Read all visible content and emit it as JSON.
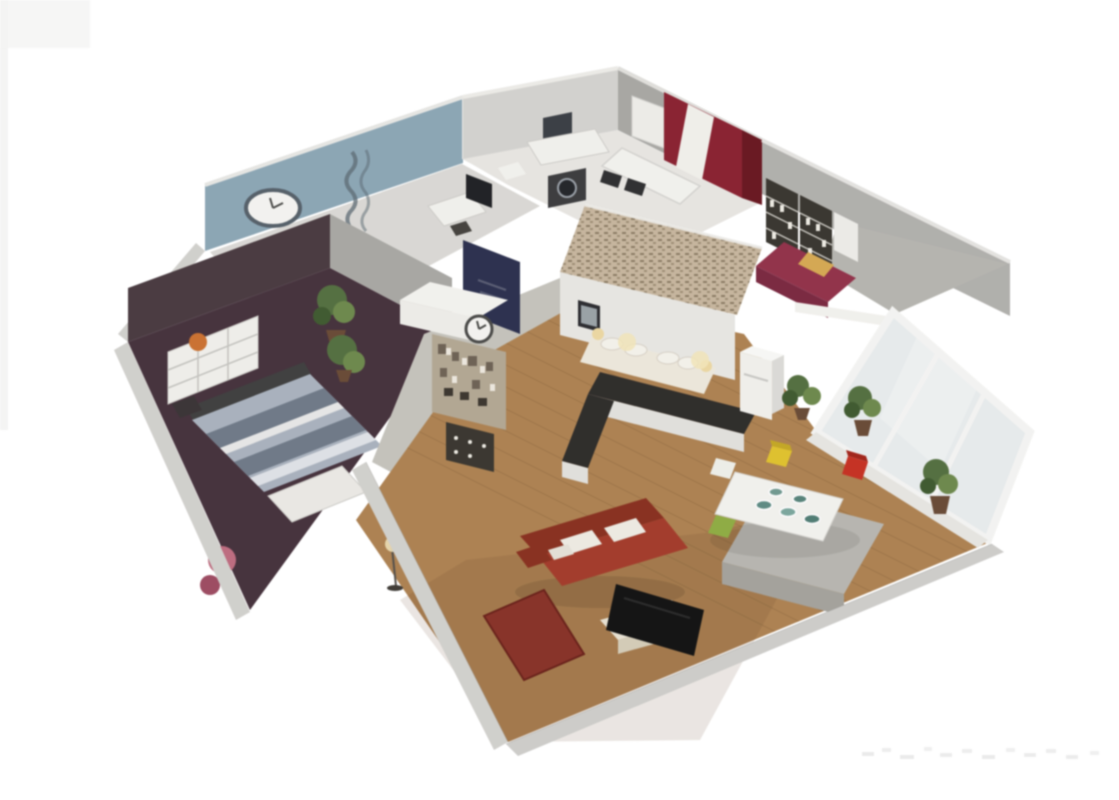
{
  "scene": {
    "description": "3d-isometric-apartment-floorplan-render",
    "background": "#ffffff",
    "blur_px": 0.8
  },
  "palette": {
    "wall_face_light": "#d5d4d0",
    "wall_face": "#b2b1ad",
    "wall_face_dark": "#a9a8a4",
    "wall_band": "#d3d2ce",
    "blue_wall": "#8ba7b7",
    "wall_blue_decal": "#5d6b75",
    "bath_floor": "#e9e7e3",
    "hall_floor": "#c6c4bc",
    "bedroom_left_floor": "#46313c",
    "bedroom_left_wall": "#4a3a40",
    "blue_room_floor": "#dcdad6",
    "wood_floor": "#b0824f",
    "wood_plank": "#946a3e",
    "canopy": "#c9b79e",
    "canopy_dot": "#8d7c63",
    "block_face_white": "#e9e8e4",
    "curtain_red": "#8f2030",
    "curtain_white": "#f3f1ec",
    "curtain_dark": "#6d1620",
    "navy_panel": "#2b3050",
    "sofa_red": "#a83a28",
    "sofa_dark": "#8d2f1d",
    "cushion_white": "#efece4",
    "rug_red": "#8c3126",
    "tv_black": "#121212",
    "tv_stand": "#e9e3d3",
    "table_white": "#f4f3ef",
    "chair_yellow": "#e3c326",
    "chair_red": "#cd2f20",
    "chair_green": "#8fae3e",
    "gray_block": "#b9b7b1",
    "daybed_red": "#96304a",
    "daybed_pillow": "#d9a94e",
    "bookshelf": "#39362f",
    "fridge": "#f2f1ed",
    "counter_dark": "#2e2c29",
    "counter_base": "#e3e2de",
    "plant_green": "#53703e",
    "plant_light": "#6d8a4a",
    "pot_brown": "#6b4a34",
    "bed_stripe_light": "#aab3c0",
    "bed_stripe_dark": "#6f7a89",
    "bench_white": "#eceae6",
    "pouf_pink": "#c26b80",
    "shelf_white": "#f1f0ec",
    "accent_orange": "#d0712c",
    "clock_face": "#f6f5f2",
    "clock_ring": "#4a4a48",
    "washer_dark": "#3c3c3e",
    "glass": "#e9edee",
    "window_frame": "#f6f6f4",
    "lamp_glow": "#eed9a0"
  },
  "rooms": [
    {
      "id": "bedroom-blue",
      "label": "bedroom-with-blue-wall"
    },
    {
      "id": "bathroom",
      "label": "bathroom-laundry"
    },
    {
      "id": "bedroom-left",
      "label": "bedroom-dark-floor"
    },
    {
      "id": "canopy-bed",
      "label": "master-bed-lattice-canopy"
    },
    {
      "id": "kitchen",
      "label": "kitchen"
    },
    {
      "id": "dining",
      "label": "dining-area"
    },
    {
      "id": "living",
      "label": "living-room"
    },
    {
      "id": "study-nook",
      "label": "reading-nook-bookshelf"
    },
    {
      "id": "hallway",
      "label": "hallway-display-cabinet"
    }
  ],
  "watermark": {
    "visible": true,
    "legible": false
  }
}
